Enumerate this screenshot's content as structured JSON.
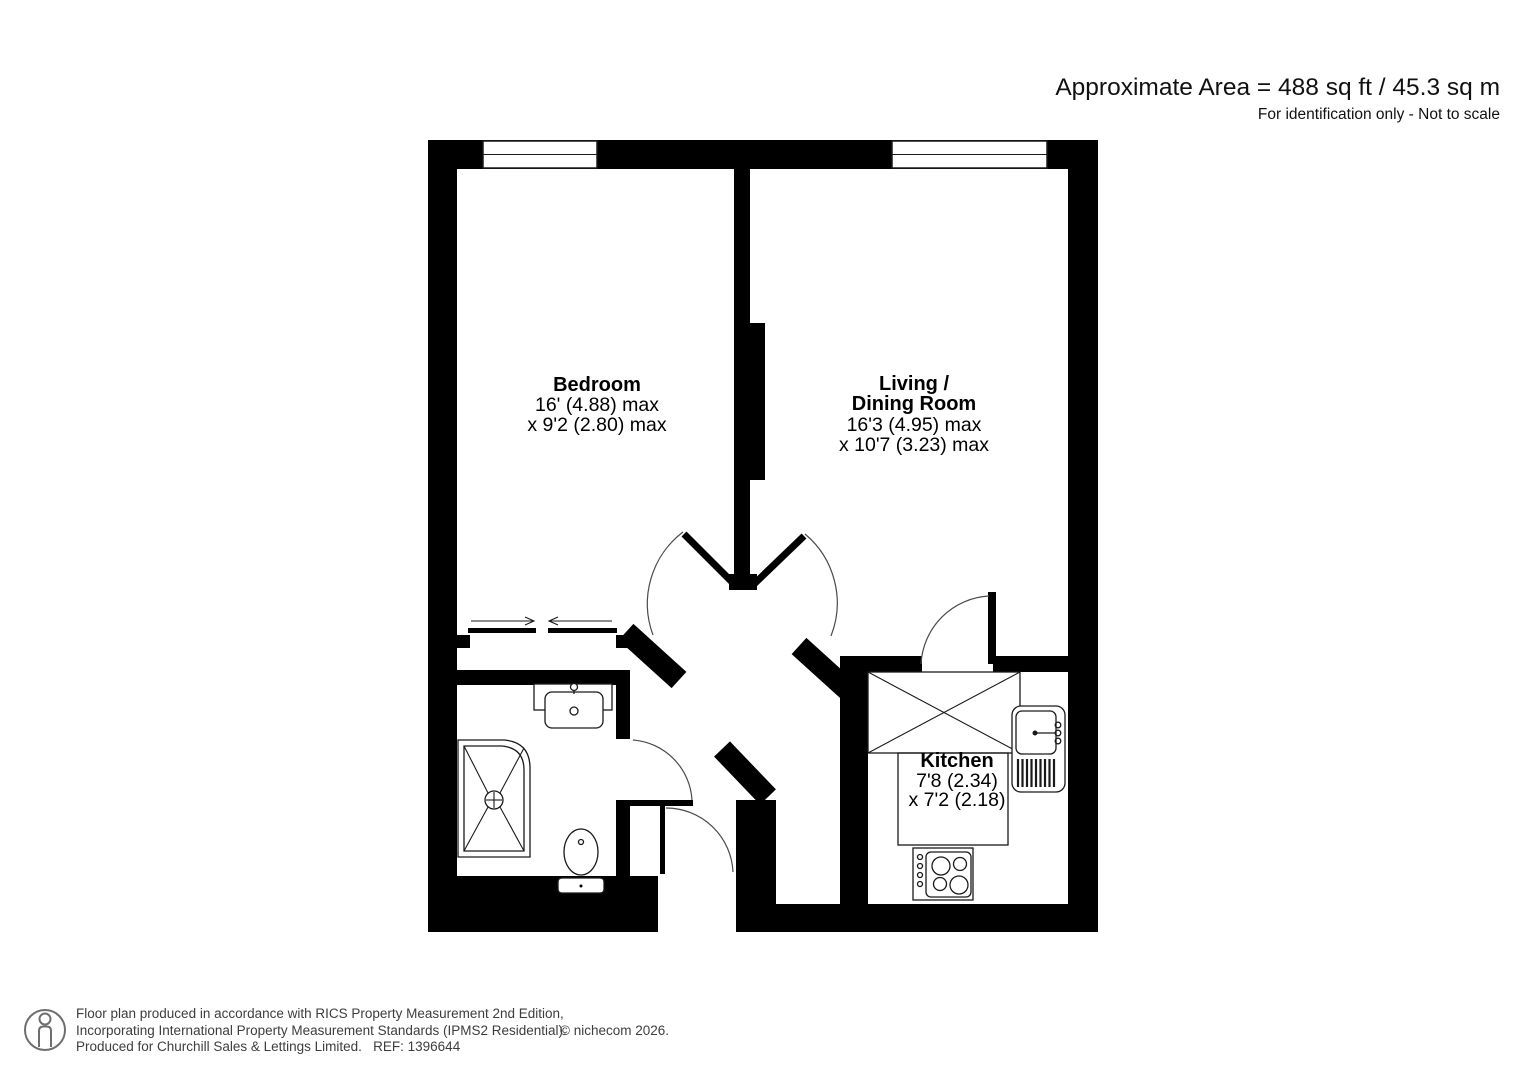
{
  "header": {
    "area": "Approximate Area = 488 sq ft / 45.3 sq m",
    "note": "For identification only - Not to scale"
  },
  "rooms": {
    "bedroom": {
      "name": "Bedroom",
      "dim1": "16' (4.88) max",
      "dim2": "x 9'2 (2.80) max"
    },
    "living": {
      "name1": "Living /",
      "name2": "Dining Room",
      "dim1": "16'3 (4.95) max",
      "dim2": "x 10'7 (3.23) max"
    },
    "kitchen": {
      "name": "Kitchen",
      "dim1": "7'8 (2.34)",
      "dim2": "x 7'2 (2.18)"
    }
  },
  "footer": {
    "icon": "person-icon",
    "line1": "Floor plan produced in accordance with RICS Property Measurement 2nd Edition,",
    "line2": "Incorporating International Property Measurement Standards (IPMS2 Residential).",
    "line3": "Produced for Churchill Sales & Lettings Limited.   REF: 1396644",
    "copyright": "© nichecom 2026."
  },
  "colors": {
    "wall": "#000000",
    "text": "#000000",
    "footer_text": "#3d3d3d"
  }
}
